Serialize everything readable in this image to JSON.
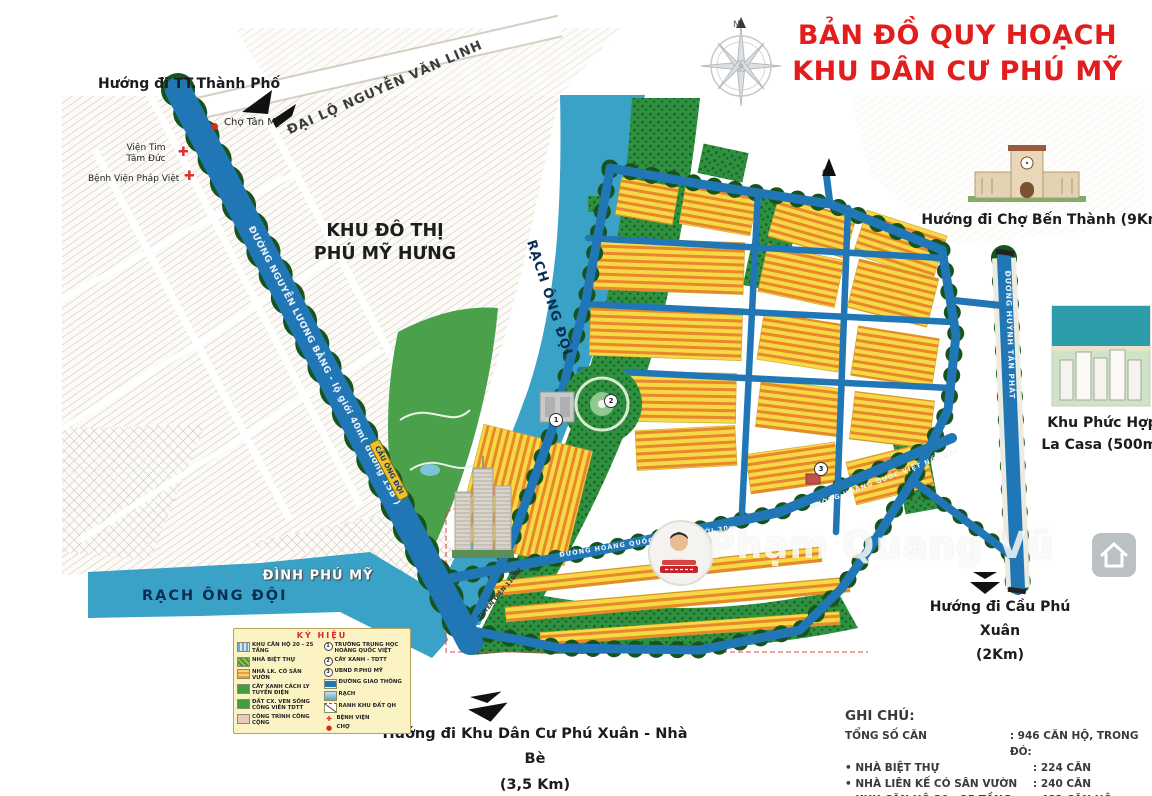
{
  "title": {
    "line1": "BẢN ĐỒ QUY HOẠCH",
    "line2": "KHU DÂN CƯ PHÚ MỸ"
  },
  "compass": {
    "north": "N"
  },
  "directions": {
    "city": "Hướng đi TT.Thành Phố",
    "ben_thanh": "Hướng đi Chợ Bến Thành (9Km)",
    "phu_xuan_1": "Hướng đi Cầu Phú Xuân",
    "phu_xuan_2": "(2Km)",
    "nha_be_1": "Hướng đi Khu Dân Cư Phú Xuân - Nhà Bè",
    "nha_be_2": "(3,5 Km)"
  },
  "landmarks": {
    "cho_tan_my": "Chợ Tân Mỹ",
    "vien_tim_1": "Viện Tim",
    "vien_tim_2": "Tâm Đức",
    "benh_vien_phap_viet": "Bệnh Viện Pháp Việt",
    "khu_do_thi_1": "KHU ĐÔ THỊ",
    "khu_do_thi_2": "PHÚ MỸ HƯNG",
    "dinh_phu_my": "ĐÌNH PHÚ MỸ",
    "la_casa_1": "Khu Phức Hợp",
    "la_casa_2": "La Casa (500m)"
  },
  "roads": {
    "nguyen_van_linh": "ĐẠI LỘ NGUYỄN VĂN LINH",
    "nguyen_luong_bang": "ĐƯỜNG NGUYỄN LƯƠNG BẰNG - lộ giới 40m( đường 15B )",
    "cau_ong_doi": "CẦU ÔNG ĐỘI",
    "rach_ong_doi_river": "RẠCH ÔNG ĐỘI",
    "rach_ong_doi_canal": "RẠCH ÔNG ĐỘI",
    "hoang_quoc_viet": "ĐƯỜNG HOÀNG QUỐC VIỆT LỘ GIỚI 30m",
    "hoang_quoc_viet_noi_dai": "ĐƯỜNG HOÀNG QUỐC VIỆT NỐI DÀI",
    "huynh_tan_phat": "ĐƯỜNG HUỲNH TẤN PHÁT",
    "tuyen_dien": "TUYẾN ĐIỆN 110KV"
  },
  "map_markers": {
    "m1": "1",
    "m2": "2",
    "m3": "3"
  },
  "legend": {
    "title": "KÝ HIỆU",
    "left": [
      {
        "label": "KHU CĂN HỘ 20 - 25 TẦNG"
      },
      {
        "label": "NHÀ BIỆT THỰ"
      },
      {
        "label": "NHÀ LK. CÓ SÂN VƯỜN"
      },
      {
        "label": "CÂY XANH CÁCH LY TUYẾN ĐIỆN"
      },
      {
        "label": "ĐẤT CX. VEN SÔNG CÔNG VIÊN TDTT"
      },
      {
        "label": "CÔNG TRÌNH CÔNG CỘNG"
      }
    ],
    "right": [
      {
        "marker": "1",
        "label": "TRƯỜNG TRUNG HỌC HOÀNG QUỐC VIỆT"
      },
      {
        "marker": "2",
        "label": "CÂY XANH - TDTT"
      },
      {
        "marker": "3",
        "label": "UBND P.PHÚ MỸ"
      },
      {
        "label": "ĐƯỜNG GIAO THÔNG"
      },
      {
        "label": "RẠCH"
      },
      {
        "label": "RANH KHU ĐẤT QH"
      },
      {
        "label": "BỆNH VIỆN"
      },
      {
        "label": "CHỢ"
      }
    ]
  },
  "notes": {
    "title": "GHI CHÚ:",
    "rows": [
      {
        "label": "TỔNG SỐ CĂN",
        "value": ": 946 CĂN HỘ, TRONG ĐÓ:"
      },
      {
        "label": "• NHÀ BIỆT THỰ",
        "value": ": 224 CĂN"
      },
      {
        "label": "• NHÀ LIÊN KẾ CÓ SÂN VƯỜN",
        "value": ": 240 CĂN"
      },
      {
        "label": "• KHU CĂN HỘ 20 - 25 TẦNG",
        "value": ": 482 CĂN HỘ"
      }
    ]
  },
  "watermark": {
    "name": "Phạm Quang Vũ"
  },
  "colors": {
    "accent_red": "#e11d1d",
    "road_blue": "#2176b5",
    "water_teal": "#3aa2c6",
    "block_yellow": "#f6d944",
    "house_orange": "#e8872b",
    "park_green": "#2f9040"
  }
}
